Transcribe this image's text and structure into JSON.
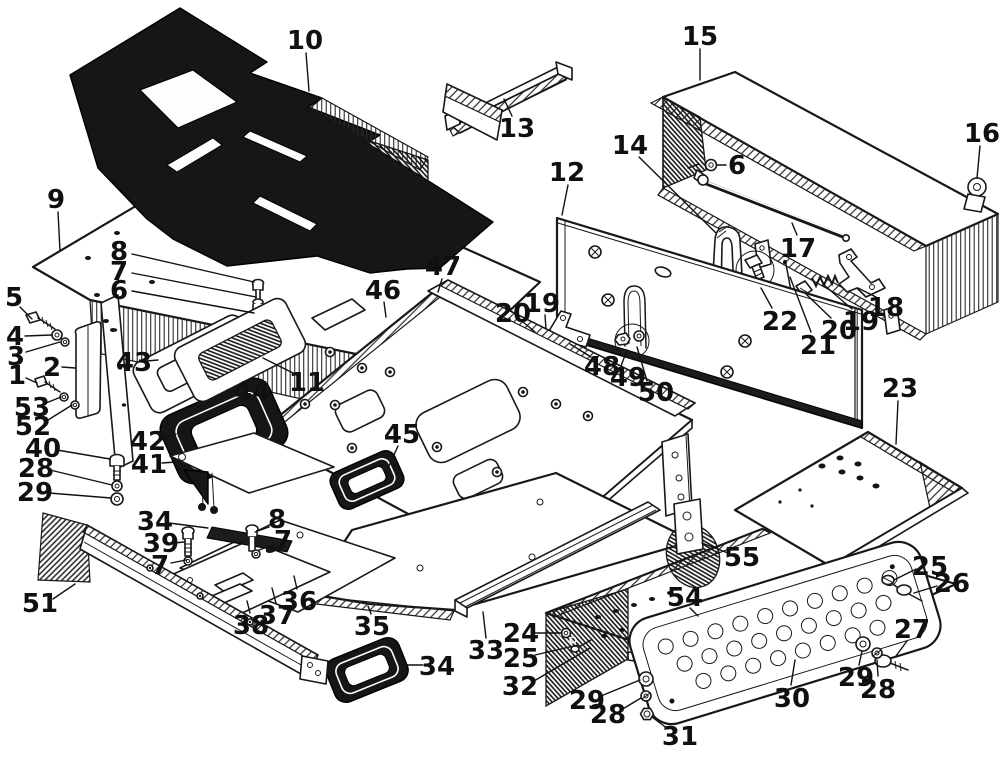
{
  "figure": {
    "type": "exploded-parts-diagram",
    "description": "Black-and-white exploded view line drawing of vehicle cab floor panels, covers, gaskets, step plate and fasteners with numbered callouts",
    "style": {
      "ink": "#111111",
      "paper": "#ffffff",
      "dark_fill": "#161616"
    }
  },
  "callouts": [
    {
      "n": "10",
      "x": 305,
      "y": 40,
      "line": [
        306,
        53,
        309,
        91
      ]
    },
    {
      "n": "9",
      "x": 56,
      "y": 199,
      "line": [
        58,
        212,
        60,
        251
      ]
    },
    {
      "n": "8",
      "x": 119,
      "y": 251,
      "line": [
        132,
        254,
        254,
        282
      ]
    },
    {
      "n": "7",
      "x": 119,
      "y": 271,
      "line": [
        132,
        273,
        256,
        297
      ]
    },
    {
      "n": "6",
      "x": 119,
      "y": 290,
      "line": [
        132,
        291,
        254,
        313
      ]
    },
    {
      "n": "5",
      "x": 14,
      "y": 297,
      "line": [
        20,
        307,
        32,
        319
      ]
    },
    {
      "n": "4",
      "x": 15,
      "y": 336,
      "line": [
        25,
        336,
        52,
        335
      ]
    },
    {
      "n": "3",
      "x": 16,
      "y": 356,
      "line": [
        26,
        352,
        60,
        342
      ]
    },
    {
      "n": "2",
      "x": 52,
      "y": 367,
      "line": [
        62,
        367,
        75,
        368
      ]
    },
    {
      "n": "1",
      "x": 17,
      "y": 375,
      "line": [
        26,
        378,
        37,
        383
      ]
    },
    {
      "n": "53",
      "x": 32,
      "y": 407,
      "line": [
        46,
        403,
        61,
        397
      ]
    },
    {
      "n": "52",
      "x": 33,
      "y": 426,
      "line": [
        48,
        420,
        72,
        405
      ]
    },
    {
      "n": "43",
      "x": 134,
      "y": 362,
      "line": [
        147,
        361,
        158,
        360
      ]
    },
    {
      "n": "44",
      "x": 252,
      "y": 391,
      "line": [
        237,
        391,
        227,
        390
      ]
    },
    {
      "n": "11",
      "x": 307,
      "y": 382,
      "line": [
        297,
        375,
        263,
        358
      ]
    },
    {
      "n": "42",
      "x": 148,
      "y": 441,
      "line": [
        161,
        439,
        176,
        434
      ]
    },
    {
      "n": "41",
      "x": 149,
      "y": 464,
      "line": [
        162,
        463,
        176,
        462
      ]
    },
    {
      "n": "40",
      "x": 43,
      "y": 448,
      "line": [
        57,
        450,
        110,
        459
      ]
    },
    {
      "n": "28",
      "x": 36,
      "y": 468,
      "line": [
        50,
        470,
        112,
        485
      ]
    },
    {
      "n": "29",
      "x": 35,
      "y": 492,
      "line": [
        49,
        493,
        111,
        498
      ]
    },
    {
      "n": "47",
      "x": 443,
      "y": 266,
      "line": [
        442,
        279,
        438,
        292
      ]
    },
    {
      "n": "46",
      "x": 383,
      "y": 290,
      "line": [
        384,
        302,
        386,
        317
      ]
    },
    {
      "n": "45",
      "x": 402,
      "y": 434,
      "line": [
        398,
        446,
        388,
        468
      ]
    },
    {
      "n": "13",
      "x": 517,
      "y": 128,
      "line": [
        512,
        116,
        504,
        99
      ]
    },
    {
      "n": "12",
      "x": 567,
      "y": 172,
      "line": [
        568,
        185,
        562,
        215
      ]
    },
    {
      "n": "14",
      "x": 630,
      "y": 145,
      "line": [
        639,
        157,
        716,
        233
      ]
    },
    {
      "n": "15",
      "x": 700,
      "y": 36,
      "line": [
        700,
        49,
        700,
        80
      ]
    },
    {
      "n": "16",
      "x": 982,
      "y": 133,
      "line": [
        980,
        146,
        977,
        178
      ]
    },
    {
      "n": "6",
      "x": 737,
      "y": 165,
      "line": [
        726,
        165,
        717,
        165
      ]
    },
    {
      "n": "17",
      "x": 798,
      "y": 248,
      "line": [
        797,
        235,
        792,
        223
      ]
    },
    {
      "n": "22",
      "x": 780,
      "y": 321,
      "line": [
        772,
        308,
        761,
        288
      ]
    },
    {
      "n": "21",
      "x": 818,
      "y": 345,
      "line": [
        811,
        332,
        790,
        277
      ]
    },
    {
      "n": "20",
      "x": 839,
      "y": 330,
      "line": [
        831,
        318,
        806,
        294
      ]
    },
    {
      "n": "19",
      "x": 861,
      "y": 321,
      "line": [
        852,
        309,
        824,
        285
      ]
    },
    {
      "n": "18",
      "x": 886,
      "y": 307,
      "line": [
        876,
        297,
        858,
        288
      ]
    },
    {
      "n": "20",
      "x": 513,
      "y": 313,
      "line": [
        523,
        322,
        535,
        332
      ]
    },
    {
      "n": "19",
      "x": 542,
      "y": 303,
      "line": [
        545,
        315,
        546,
        329
      ]
    },
    {
      "n": "48",
      "x": 602,
      "y": 366,
      "line": [
        591,
        357,
        570,
        344
      ]
    },
    {
      "n": "49",
      "x": 628,
      "y": 377,
      "line": [
        621,
        366,
        627,
        350
      ]
    },
    {
      "n": "50",
      "x": 656,
      "y": 392,
      "line": [
        647,
        381,
        637,
        347
      ]
    },
    {
      "n": "23",
      "x": 900,
      "y": 388,
      "line": [
        898,
        401,
        896,
        444
      ]
    },
    {
      "n": "55",
      "x": 742,
      "y": 557,
      "line": [
        728,
        553,
        702,
        543
      ]
    },
    {
      "n": "54",
      "x": 685,
      "y": 597,
      "line": [
        690,
        608,
        698,
        616
      ]
    },
    {
      "n": "24",
      "x": 521,
      "y": 633,
      "line": [
        535,
        633,
        562,
        633
      ]
    },
    {
      "n": "25",
      "x": 521,
      "y": 658,
      "line": [
        535,
        655,
        578,
        645
      ]
    },
    {
      "n": "32",
      "x": 520,
      "y": 686,
      "line": [
        534,
        681,
        590,
        648
      ]
    },
    {
      "n": "29",
      "x": 587,
      "y": 700,
      "line": [
        601,
        696,
        640,
        680
      ]
    },
    {
      "n": "28",
      "x": 608,
      "y": 714,
      "line": [
        621,
        710,
        641,
        698
      ]
    },
    {
      "n": "31",
      "x": 680,
      "y": 736,
      "line": [
        668,
        729,
        652,
        717
      ]
    },
    {
      "n": "25",
      "x": 930,
      "y": 566,
      "line": [
        916,
        569,
        894,
        580
      ]
    },
    {
      "n": "26",
      "x": 952,
      "y": 583,
      "line": [
        937,
        586,
        914,
        593
      ]
    },
    {
      "n": "27",
      "x": 912,
      "y": 629,
      "line": [
        907,
        641,
        896,
        656
      ]
    },
    {
      "n": "29",
      "x": 856,
      "y": 677,
      "line": [
        859,
        665,
        862,
        651
      ]
    },
    {
      "n": "28",
      "x": 878,
      "y": 689,
      "line": [
        878,
        676,
        877,
        660
      ]
    },
    {
      "n": "30",
      "x": 792,
      "y": 698,
      "line": [
        791,
        685,
        795,
        660
      ]
    },
    {
      "n": "51",
      "x": 40,
      "y": 603,
      "line": [
        53,
        599,
        75,
        584
      ]
    },
    {
      "n": "34",
      "x": 155,
      "y": 521,
      "line": [
        169,
        523,
        208,
        528
      ]
    },
    {
      "n": "39",
      "x": 161,
      "y": 543,
      "line": [
        174,
        543,
        184,
        542
      ]
    },
    {
      "n": "7",
      "x": 160,
      "y": 565,
      "line": [
        171,
        563,
        186,
        560
      ]
    },
    {
      "n": "8",
      "x": 277,
      "y": 519,
      "line": [
        269,
        527,
        255,
        532
      ]
    },
    {
      "n": "7",
      "x": 283,
      "y": 540,
      "line": [
        273,
        545,
        259,
        550
      ]
    },
    {
      "n": "38",
      "x": 251,
      "y": 625,
      "line": [
        250,
        613,
        247,
        601
      ]
    },
    {
      "n": "37",
      "x": 277,
      "y": 615,
      "line": [
        276,
        603,
        272,
        588
      ]
    },
    {
      "n": "36",
      "x": 299,
      "y": 601,
      "line": [
        297,
        589,
        294,
        576
      ]
    },
    {
      "n": "35",
      "x": 372,
      "y": 626,
      "line": [
        371,
        614,
        368,
        606
      ]
    },
    {
      "n": "34",
      "x": 437,
      "y": 666,
      "line": [
        423,
        665,
        407,
        665
      ]
    },
    {
      "n": "33",
      "x": 486,
      "y": 650,
      "line": [
        486,
        638,
        483,
        612
      ]
    }
  ]
}
